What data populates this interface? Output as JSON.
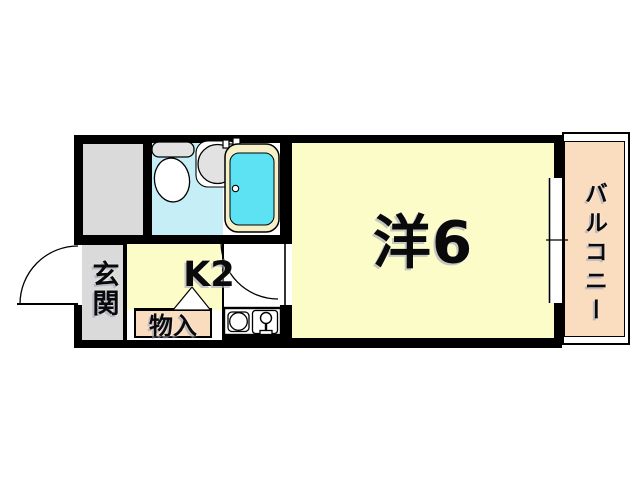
{
  "diagram_type": "apartment-floor-plan",
  "rooms": {
    "western": {
      "label": "洋6"
    },
    "kitchen": {
      "label": "K2"
    },
    "entrance": {
      "label": "玄関"
    },
    "storage": {
      "label": "物入"
    },
    "balcony": {
      "label": "バルコニー"
    }
  },
  "fixtures": [
    "toilet",
    "wash-basin",
    "bathtub",
    "bath-faucet",
    "kitchen-sink",
    "sink-faucet",
    "entrance-door-swing",
    "interior-door-swing",
    "closet-door-triangle",
    "window"
  ],
  "colors": {
    "wall": "#000000",
    "room_yellow": "#fcfcc8",
    "balcony_peach": "#fadcbe",
    "storage_peach": "#fadcbe",
    "gray_area": "#dadada",
    "bathroom_cyan": "#c6eef6",
    "bathtub_water_cyan": "#5ce2f2",
    "bathtub_rim_cream": "#f5f0c8",
    "fixture_gray": "#e2e2e2",
    "background": "#ffffff"
  }
}
